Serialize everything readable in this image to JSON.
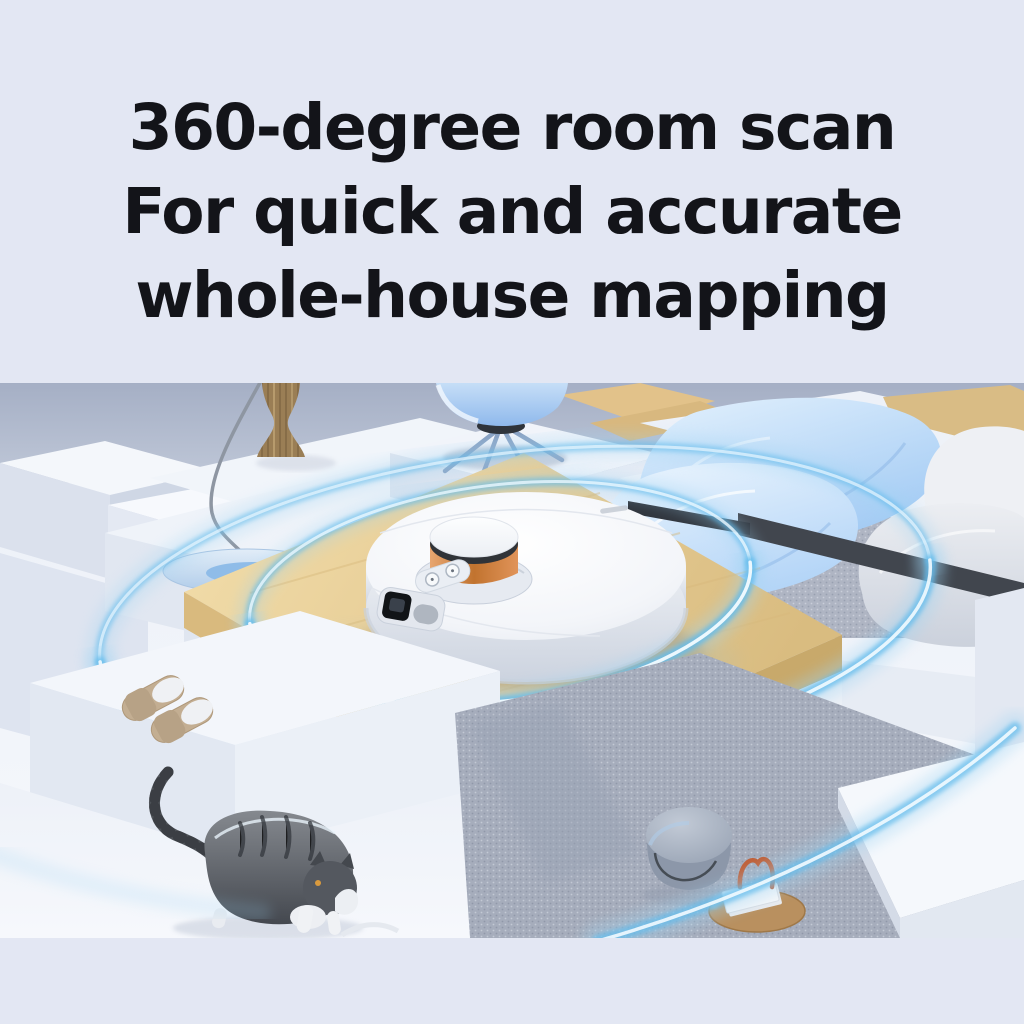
{
  "page": {
    "type": "product-marketing-banner",
    "background_color": "#E3E7F3"
  },
  "headline": {
    "lines": [
      "360-degree room scan",
      "For quick and accurate",
      "whole-house mapping"
    ],
    "text_color": "#131419"
  },
  "scene": {
    "name": "robot-vacuum-lidar-room-scan",
    "objects": [
      {
        "name": "wall",
        "color": "#A5AFC5"
      },
      {
        "name": "white-blocks",
        "color": "#F1F4FA"
      },
      {
        "name": "wooden-platform",
        "color": "#E7CD96"
      },
      {
        "name": "robot-vacuum",
        "color": "#FAFBFD"
      },
      {
        "name": "lidar-turret-copper-ring",
        "color": "#C1732F"
      },
      {
        "name": "scan-rings",
        "color": "#63BCEC"
      },
      {
        "name": "arc-floor-lamp",
        "color": "#8E96A2"
      },
      {
        "name": "wavy-wood-vase",
        "color": "#9A7E55"
      },
      {
        "name": "blue-shell-chair",
        "color": "#8FB9EC"
      },
      {
        "name": "ice-blue-cushions",
        "color": "#A3CBF4"
      },
      {
        "name": "gray-pillows",
        "color": "#CBD1DC"
      },
      {
        "name": "bench-slab",
        "color": "#41464E"
      },
      {
        "name": "carpet-rug",
        "color": "#A6ADBC"
      },
      {
        "name": "slippers",
        "color": "#C3AE92"
      },
      {
        "name": "tabby-cat",
        "color": "#4C5057"
      },
      {
        "name": "mushroom-stool",
        "color": "#96A1B2"
      },
      {
        "name": "wooden-tray-with-book",
        "color": "#B9905F"
      }
    ]
  }
}
